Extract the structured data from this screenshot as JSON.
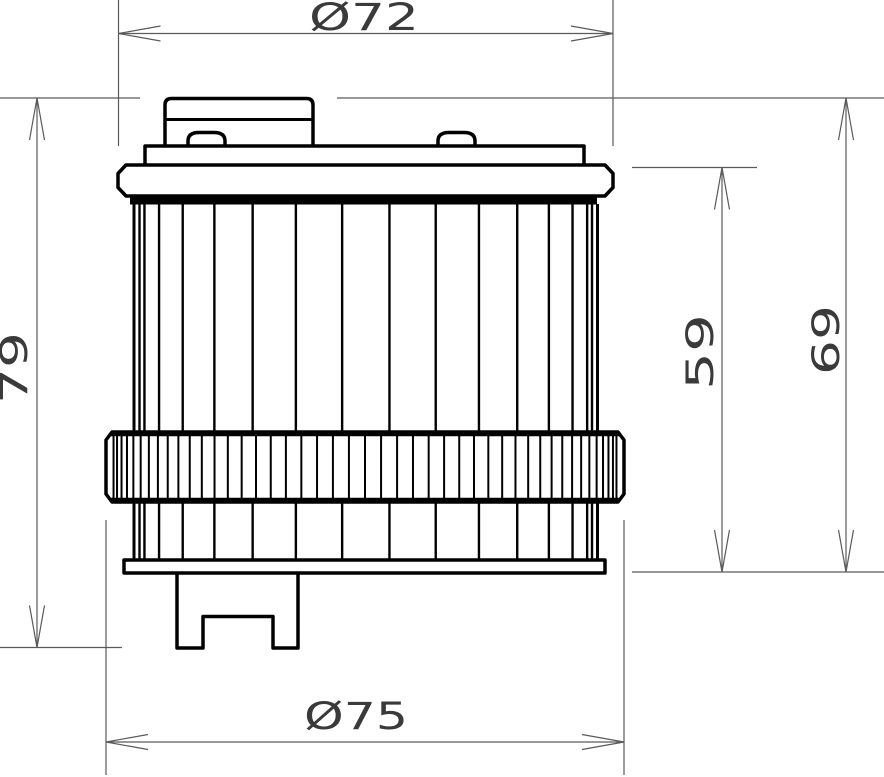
{
  "dimensions": {
    "top_diameter": {
      "label": "Ø72",
      "value": 72
    },
    "bottom_ring_diameter": {
      "label": "Ø75",
      "value": 75
    },
    "overall_height": {
      "label": "79",
      "value": 79
    },
    "element_height": {
      "label": "59",
      "value": 59
    },
    "plate_to_base_height": {
      "label": "69",
      "value": 69
    }
  },
  "colors": {
    "background": "#ffffff",
    "outline": "#000000",
    "dimension_line": "#5a5a5a",
    "dimension_text": "#3a3a3a"
  }
}
